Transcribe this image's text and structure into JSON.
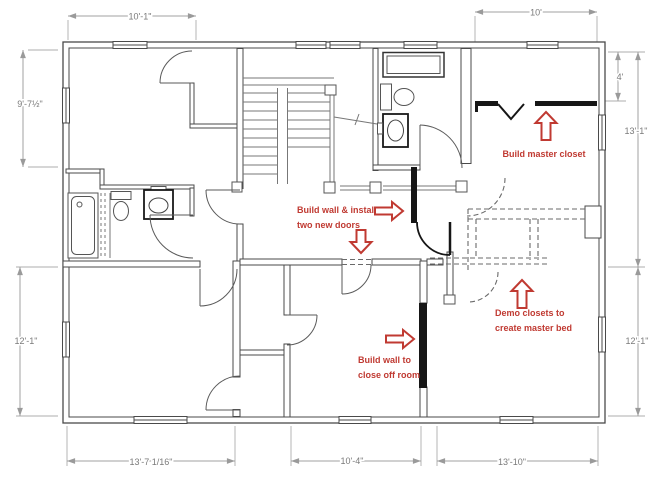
{
  "document": {
    "type": "floor-plan-drawing",
    "description": "second-floor remodel plan with dimensions and red renovation notes"
  },
  "dimensions": {
    "top_left_width": "10'-1\"",
    "top_right_width": "10'",
    "left_upper_height": "9'-7½\"",
    "left_lower_height": "12'-1\"",
    "right_upper_height": "13'-1\"",
    "closet_depth": "4'",
    "right_lower_height": "12'-1\"",
    "bottom_left_width": "13'-7 1/16\"",
    "bottom_middle_width": "10'-4\"",
    "bottom_right_width": "13'-10\""
  },
  "annotations": {
    "master_closet": {
      "line1": "Build master closet"
    },
    "new_wall_doors": {
      "line1": "Build wall & install",
      "line2": "two new doors"
    },
    "close_off_room": {
      "line1": "Build wall to",
      "line2": "close off room"
    },
    "demo_closets": {
      "line1": "Demo closets to",
      "line2": "create master bed"
    }
  },
  "colors": {
    "wall": "#4a4a4a",
    "new_wall": "#161616",
    "dimension_line": "#a0a0a0",
    "dimension_text": "#7a7a7a",
    "annotation_red": "#c03a32",
    "background": "#ffffff"
  },
  "fixtures": [
    "bathtub",
    "toilet",
    "sink",
    "shower",
    "stairs",
    "railing",
    "chimney"
  ]
}
